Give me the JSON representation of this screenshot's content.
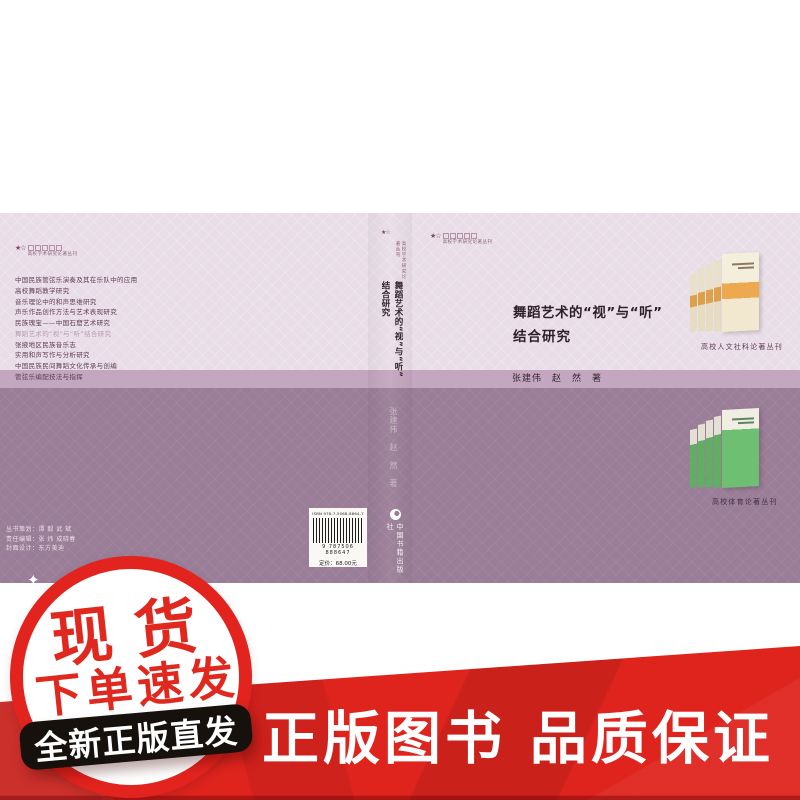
{
  "colors": {
    "cover_light": "#e9dde7",
    "cover_band": "#c3a6bf",
    "cover_dark": "#9a7d97",
    "title_text": "#2f1f2a",
    "badge_red": "#e3231e",
    "banner_red": "#df241e",
    "black_banner": "#17110d",
    "orange_band": "#eda94f",
    "green_cover": "#6fbf72"
  },
  "back_cover": {
    "series_logo": "高校学术研究论著丛刊",
    "book_list": [
      {
        "label": "中国民族管弦乐演奏及其在乐队中的应用",
        "highlight": false
      },
      {
        "label": "高校舞蹈教学研究",
        "highlight": false
      },
      {
        "label": "音乐理论中的和声思维研究",
        "highlight": false
      },
      {
        "label": "声乐作品创作方法与艺术表现研究",
        "highlight": false
      },
      {
        "label": "民族瑰宝——中国石窟艺术研究",
        "highlight": false
      },
      {
        "label": "舞蹈艺术的“视”与“听”结合研究",
        "highlight": true
      },
      {
        "label": "张掖地区民族音乐志",
        "highlight": false
      },
      {
        "label": "实用和声写作与分析研究",
        "highlight": false
      },
      {
        "label": "中国民族民间舞蹈文化传承与创编",
        "highlight": false
      },
      {
        "label": "管弦乐编配技法与指挥",
        "highlight": false
      }
    ]
  },
  "spine_top": {
    "stars": "★☆",
    "series": "高校学术研究论著丛刊",
    "title_line1": "舞蹈艺术的“视”与“听”",
    "title_line2": "结合研究"
  },
  "front_cover": {
    "stars": "★☆",
    "series_logo": "高校学术研究论著丛刊",
    "title_line1": "舞蹈艺术的“视”与“听”",
    "title_line2": "结合研究",
    "authors": "张建伟　赵　然　著",
    "fan_caption": "高校人文社科论著丛刊"
  },
  "bottom_half": {
    "credits_line1": "丛书策划：谭 毅  武 斌",
    "credits_line2": "责任编辑：张 炜  成晓春",
    "credits_line3": "封面设计：东方美迪",
    "spine_authors": "张建伟　赵　然　著",
    "isbn_text": "ISBN 978-7-5068-8864-7",
    "barcode_digits": "9 787506 888647",
    "price": "定价：68.00元",
    "publisher": "中国书籍出版社",
    "fan_caption": "高校体育论著丛刊"
  },
  "overlays": {
    "badge_line1": "现货",
    "badge_line2": "下单速发",
    "sparkle": "✦",
    "black_banner_text": "全新正版直发",
    "bottom_banner_text": "正版图书 品质保证"
  }
}
